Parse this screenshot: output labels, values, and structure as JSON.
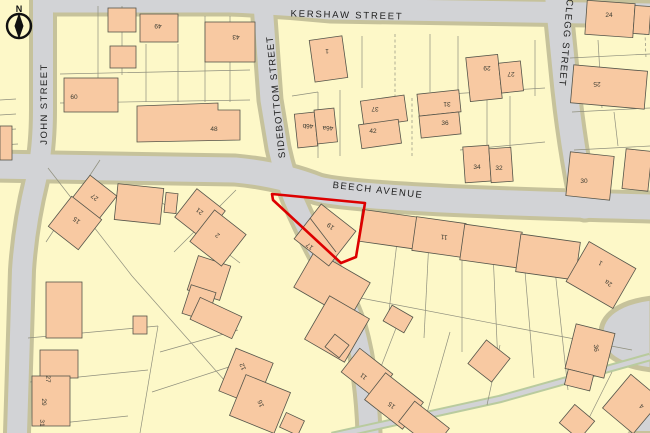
{
  "map": {
    "compass": {
      "label": "N"
    },
    "streets": [
      {
        "name": "KERSHAW STREET",
        "x": 347,
        "y": 15,
        "rot": 1.5,
        "spacing": 1.8
      },
      {
        "name": "BEECH AVENUE",
        "x": 378,
        "y": 190,
        "rot": 6.5,
        "spacing": 1.5
      },
      {
        "name": "JOHN STREET",
        "x": 44,
        "y": 104,
        "rot": -90,
        "spacing": 1.4
      },
      {
        "name": "SIDEBOTTOM STREET",
        "x": 276,
        "y": 97,
        "rot": -96,
        "spacing": 1.2
      },
      {
        "name": "CLEGG STREET",
        "x": 566,
        "y": 43,
        "rot": 95,
        "spacing": 1.2
      }
    ],
    "house_numbers": [
      {
        "text": "49",
        "x": 158,
        "y": 27,
        "rot": 180
      },
      {
        "text": "43",
        "x": 236,
        "y": 38,
        "rot": 180
      },
      {
        "text": "60",
        "x": 74,
        "y": 96,
        "rot": 0
      },
      {
        "text": "48",
        "x": 214,
        "y": 128,
        "rot": 0
      },
      {
        "text": "1",
        "x": 327,
        "y": 52,
        "rot": 180
      },
      {
        "text": "46b",
        "x": 308,
        "y": 127,
        "rot": 180
      },
      {
        "text": "46a",
        "x": 328,
        "y": 129,
        "rot": 180
      },
      {
        "text": "37",
        "x": 375,
        "y": 110,
        "rot": 180
      },
      {
        "text": "42",
        "x": 373,
        "y": 130,
        "rot": 0
      },
      {
        "text": "31",
        "x": 447,
        "y": 105,
        "rot": 180
      },
      {
        "text": "36",
        "x": 445,
        "y": 122,
        "rot": 0
      },
      {
        "text": "29",
        "x": 487,
        "y": 69,
        "rot": 180
      },
      {
        "text": "27",
        "x": 511,
        "y": 75,
        "rot": 180
      },
      {
        "text": "34",
        "x": 477,
        "y": 166,
        "rot": 0
      },
      {
        "text": "32",
        "x": 499,
        "y": 167,
        "rot": 0
      },
      {
        "text": "24",
        "x": 609,
        "y": 14,
        "rot": 0
      },
      {
        "text": "25",
        "x": 597,
        "y": 85,
        "rot": 180
      },
      {
        "text": "30",
        "x": 584,
        "y": 180,
        "rot": 0
      },
      {
        "text": "19",
        "x": 330,
        "y": 227,
        "rot": 218
      },
      {
        "text": "17",
        "x": 309,
        "y": 247,
        "rot": 218
      },
      {
        "text": "11",
        "x": 444,
        "y": 238,
        "rot": 188
      },
      {
        "text": "1",
        "x": 600,
        "y": 264,
        "rot": 210
      },
      {
        "text": "2a",
        "x": 608,
        "y": 284,
        "rot": 210
      },
      {
        "text": "21",
        "x": 199,
        "y": 212,
        "rot": 218
      },
      {
        "text": "2",
        "x": 217,
        "y": 236,
        "rot": 218
      },
      {
        "text": "27",
        "x": 94,
        "y": 198,
        "rot": 218
      },
      {
        "text": "15",
        "x": 76,
        "y": 221,
        "rot": 218
      },
      {
        "text": "27",
        "x": 49,
        "y": 379,
        "rot": 90
      },
      {
        "text": "29",
        "x": 45,
        "y": 402,
        "rot": 90
      },
      {
        "text": "31",
        "x": 43,
        "y": 423,
        "rot": 90
      },
      {
        "text": "12",
        "x": 242,
        "y": 367,
        "rot": 248
      },
      {
        "text": "16",
        "x": 260,
        "y": 404,
        "rot": 248
      },
      {
        "text": "11",
        "x": 363,
        "y": 377,
        "rot": 218
      },
      {
        "text": "15",
        "x": 391,
        "y": 406,
        "rot": 218
      },
      {
        "text": "36",
        "x": 597,
        "y": 348,
        "rot": 85
      },
      {
        "text": "4",
        "x": 641,
        "y": 407,
        "rot": 220
      }
    ],
    "highlight_plot": {
      "numbers": "19",
      "outline_color": "#dd0000"
    },
    "colors": {
      "parcel": "#fdf8c8",
      "building": "#f8c9a2",
      "road": "#d2d3d6",
      "road_edge": "#c6c29b",
      "green_space": "#d9efc4",
      "plot_outline": "#dd0000"
    }
  }
}
